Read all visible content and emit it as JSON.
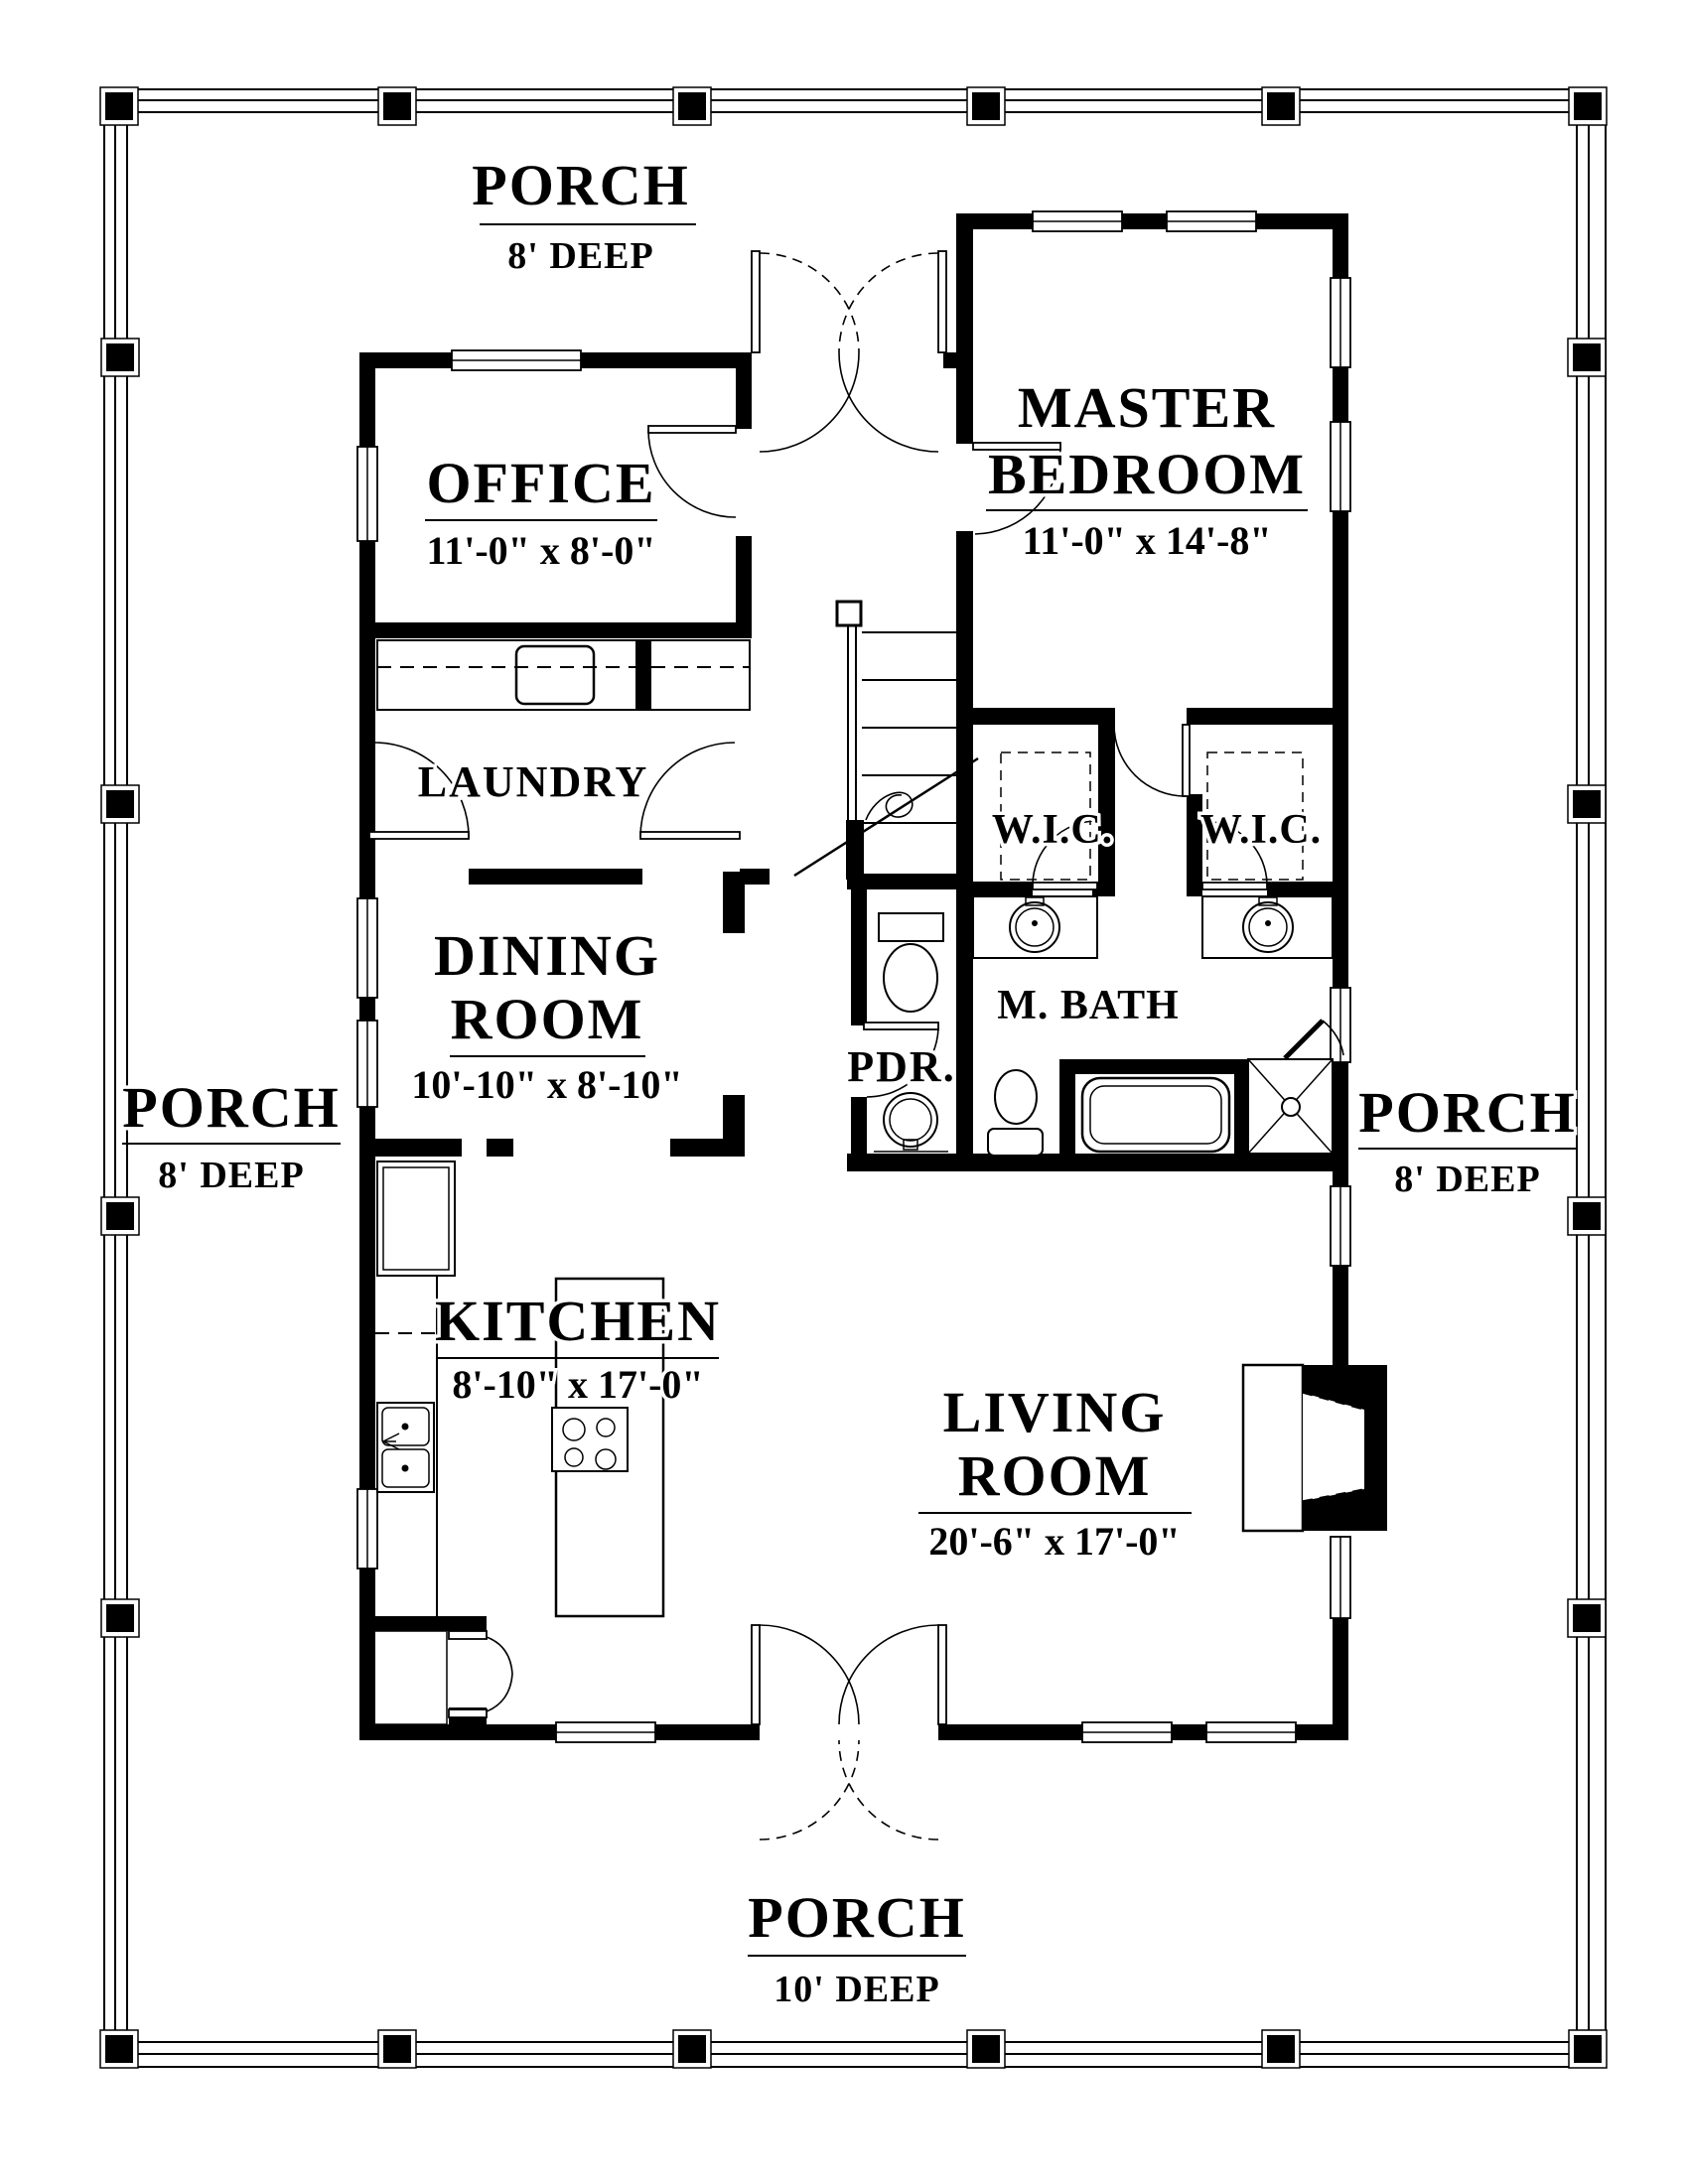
{
  "plan": {
    "colors": {
      "ink": "#000000",
      "paper": "#ffffff"
    },
    "porch_top": {
      "name": "PORCH",
      "depth": "8' DEEP"
    },
    "porch_left": {
      "name": "PORCH",
      "depth": "8' DEEP"
    },
    "porch_right": {
      "name": "PORCH",
      "depth": "8' DEEP"
    },
    "porch_bottom": {
      "name": "PORCH",
      "depth": "10' DEEP"
    },
    "office": {
      "name": "OFFICE",
      "dims": "11'-0\" x 8'-0\""
    },
    "master_bedroom": {
      "line1": "MASTER",
      "line2": "BEDROOM",
      "dims": "11'-0\" x 14'-8\""
    },
    "laundry": {
      "name": "LAUNDRY"
    },
    "dining": {
      "line1": "DINING",
      "line2": "ROOM",
      "dims": "10'-10\" x 8'-10\""
    },
    "kitchen": {
      "name": "KITCHEN",
      "dims": "8'-10\" x 17'-0\""
    },
    "living": {
      "line1": "LIVING",
      "line2": "ROOM",
      "dims": "20'-6\" x 17'-0\""
    },
    "wic_left": {
      "name": "W.I.C."
    },
    "wic_right": {
      "name": "W.I.C."
    },
    "master_bath": {
      "name": "M. BATH"
    },
    "powder": {
      "name": "PDR."
    },
    "fixtures": [
      "staircase",
      "washer-dryer",
      "refrigerator",
      "kitchen-sink",
      "island-cooktop",
      "pantry-closet",
      "powder-toilet",
      "powder-pedestal-sink",
      "vanity-sink-left",
      "vanity-sink-right",
      "master-toilet",
      "bathtub",
      "corner-shower",
      "fireplace",
      "french-doors-front",
      "french-doors-rear"
    ]
  }
}
